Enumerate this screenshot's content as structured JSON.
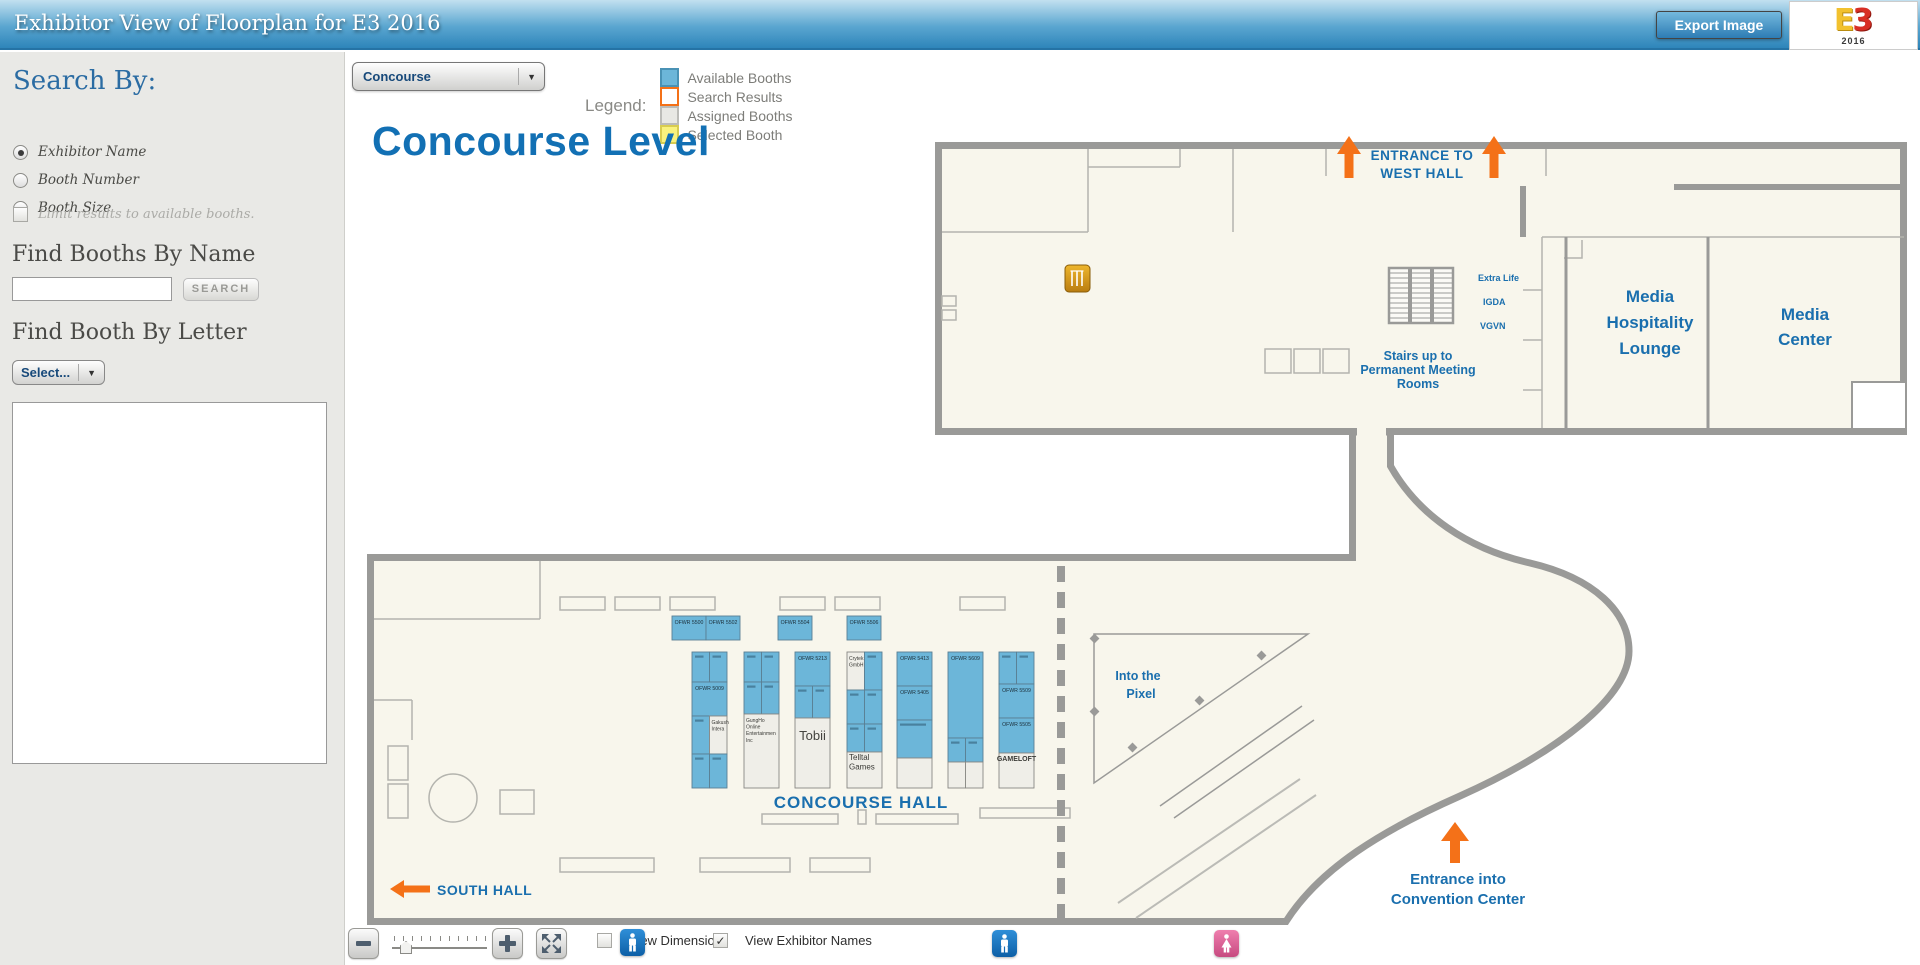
{
  "header": {
    "title": "Exhibitor View of Floorplan for E3 2016",
    "export_button": "Export Image",
    "logo": {
      "e": "E",
      "three": "3",
      "year": "2016"
    }
  },
  "sidebar": {
    "search_by_label": "Search By:",
    "radios": [
      {
        "label": "Exhibitor Name",
        "selected": true
      },
      {
        "label": "Booth Number",
        "selected": false
      },
      {
        "label": "Booth Size",
        "selected": false
      }
    ],
    "limit_checkbox_label": "Limit results to available booths.",
    "find_by_name_label": "Find Booths By Name",
    "name_input_value": "",
    "search_button": "SEARCH",
    "find_by_letter_label": "Find Booth By Letter",
    "letter_select_value": "Select..."
  },
  "top_controls": {
    "level_select_value": "Concourse",
    "legend_label": "Legend:",
    "legend_items": [
      {
        "label": "Available Booths",
        "fill": "#6cb6d9",
        "border": "#4a92b5"
      },
      {
        "label": "Search Results",
        "fill": "#ffffff",
        "border": "#f47118"
      },
      {
        "label": "Assigned Booths",
        "fill": "#e8e8e4",
        "border": "#bcbcb8"
      },
      {
        "label": "Selected Booth",
        "fill": "#f9f27e",
        "border": "#d8cc50"
      }
    ]
  },
  "map": {
    "title": "Concourse Level",
    "colors": {
      "booth_blue": "#6cb6d9",
      "orange": "#f47118",
      "blue_text": "#1a6fae",
      "wall": "#9a9a98"
    },
    "labels": {
      "entrance_west_line1": "ENTRANCE TO",
      "entrance_west_line2": "WEST HALL",
      "extra_life": "Extra Life",
      "igda": "IGDA",
      "vgvn": "VGVN",
      "stairs_line1": "Stairs up to",
      "stairs_line2": "Permanent Meeting",
      "stairs_line3": "Rooms",
      "media_lounge_line1": "Media",
      "media_lounge_line2": "Hospitality",
      "media_lounge_line3": "Lounge",
      "media_center_line1": "Media",
      "media_center_line2": "Center",
      "into_pixel_line1": "Into the",
      "into_pixel_line2": "Pixel",
      "concourse_hall": "CONCOURSE HALL",
      "south_hall": "SOUTH HALL",
      "entrance_cc_line1": "Entrance into",
      "entrance_cc_line2": "Convention Center"
    },
    "booths": {
      "top_y": 616,
      "top_h": 24,
      "top_w": 34,
      "col_y": 652,
      "col_w": 35,
      "top": [
        {
          "x": 672,
          "label": "OFWR 5500"
        },
        {
          "x": 706,
          "label": "OFWR 5502"
        },
        {
          "x": 778,
          "label": "OFWR 5504"
        },
        {
          "x": 847,
          "label": "OFWR 5506"
        }
      ],
      "columns": [
        {
          "x": 692,
          "rows": [
            {
              "h": 30,
              "cells": [
                {
                  "t": "b"
                },
                {
                  "t": "b"
                }
              ]
            },
            {
              "h": 34,
              "cells": [
                {
                  "t": "b",
                  "label": "OFWR 5009"
                }
              ]
            },
            {
              "h": 38,
              "cells": [
                {
                  "t": "b"
                },
                {
                  "t": "w",
                  "label": "Gakushu Interactive",
                  "size": 5
                }
              ]
            },
            {
              "h": 34,
              "cells": [
                {
                  "t": "b"
                },
                {
                  "t": "b"
                }
              ]
            }
          ]
        },
        {
          "x": 744,
          "rows": [
            {
              "h": 30,
              "cells": [
                {
                  "t": "b"
                },
                {
                  "t": "b"
                }
              ]
            },
            {
              "h": 32,
              "cells": [
                {
                  "t": "b"
                },
                {
                  "t": "b"
                }
              ]
            },
            {
              "h": 74,
              "cells": [
                {
                  "t": "w",
                  "label": "GungHo Online Entertainment Inc",
                  "size": 5
                }
              ]
            }
          ]
        },
        {
          "x": 795,
          "rows": [
            {
              "h": 34,
              "cells": [
                {
                  "t": "b",
                  "label": "OFWR 5213"
                }
              ]
            },
            {
              "h": 32,
              "cells": [
                {
                  "t": "b"
                },
                {
                  "t": "b"
                }
              ]
            },
            {
              "h": 70,
              "cells": [
                {
                  "t": "w",
                  "label": "Tobii",
                  "size": 13
                }
              ]
            }
          ]
        },
        {
          "x": 847,
          "rows": [
            {
              "h": 38,
              "cells": [
                {
                  "t": "w",
                  "label": "Crytek GmbH",
                  "size": 5
                },
                {
                  "t": "b"
                }
              ]
            },
            {
              "h": 34,
              "cells": [
                {
                  "t": "b"
                },
                {
                  "t": "b"
                }
              ]
            },
            {
              "h": 28,
              "cells": [
                {
                  "t": "b"
                },
                {
                  "t": "b"
                }
              ]
            },
            {
              "h": 36,
              "cells": [
                {
                  "t": "w",
                  "label": "Telltale Games",
                  "size": 8
                }
              ]
            }
          ]
        },
        {
          "x": 897,
          "rows": [
            {
              "h": 34,
              "cells": [
                {
                  "t": "b",
                  "label": "OFWR 5413"
                }
              ]
            },
            {
              "h": 34,
              "cells": [
                {
                  "t": "b",
                  "label": "OFWR 5405"
                }
              ]
            },
            {
              "h": 38,
              "cells": [
                {
                  "t": "b"
                }
              ]
            },
            {
              "h": 30,
              "cells": [
                {
                  "t": "w",
                  "label": ""
                }
              ]
            }
          ]
        },
        {
          "x": 948,
          "rows": [
            {
              "h": 86,
              "cells": [
                {
                  "t": "b",
                  "label": "OFWR 5609"
                }
              ]
            },
            {
              "h": 24,
              "cells": [
                {
                  "t": "b"
                },
                {
                  "t": "b"
                }
              ]
            },
            {
              "h": 26,
              "cells": [
                {
                  "t": "w",
                  "label": ""
                },
                {
                  "t": "w",
                  "label": ""
                }
              ]
            }
          ]
        },
        {
          "x": 999,
          "rows": [
            {
              "h": 32,
              "cells": [
                {
                  "t": "b"
                },
                {
                  "t": "b"
                }
              ]
            },
            {
              "h": 34,
              "cells": [
                {
                  "t": "b",
                  "label": "OFWR 5509"
                }
              ]
            },
            {
              "h": 35,
              "cells": [
                {
                  "t": "b",
                  "label": "OFWR 5505"
                }
              ]
            },
            {
              "h": 35,
              "cells": [
                {
                  "t": "w",
                  "label": "GAMELOFT",
                  "size": 7,
                  "bold": true
                }
              ]
            }
          ]
        }
      ]
    }
  },
  "bottom_toolbar": {
    "view_dimensions_label": "View Dimensions",
    "view_names_label": "View Exhibitor Names",
    "dimensions_checked": false,
    "names_checked": true
  }
}
